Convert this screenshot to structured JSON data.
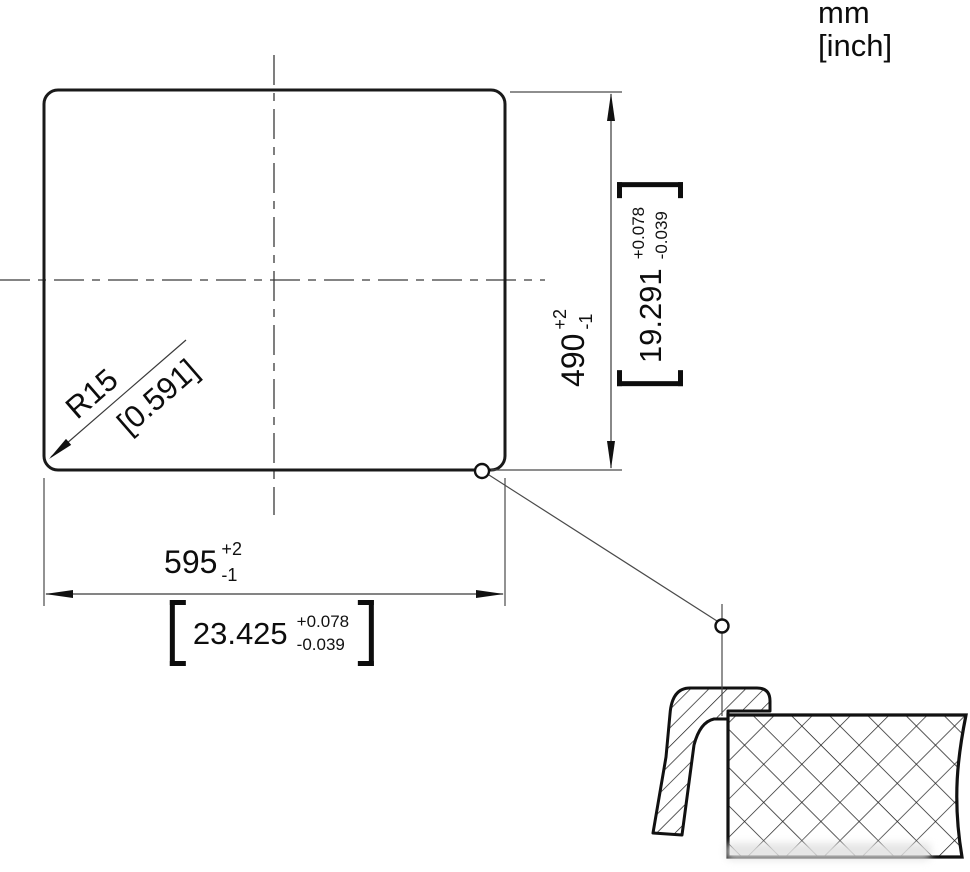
{
  "drawing": {
    "type": "installation cutout dimension drawing",
    "units_legend": {
      "line1": "mm",
      "line2": "[inch]"
    },
    "width_dim": {
      "mm": "595",
      "mm_tol_plus": "+2",
      "mm_tol_minus": "-1",
      "inch": "23.425",
      "inch_tol_plus": "+0.078",
      "inch_tol_minus": "-0.039"
    },
    "height_dim": {
      "mm": "490",
      "mm_tol_plus": "+2",
      "mm_tol_minus": "-1",
      "inch": "19.291",
      "inch_tol_plus": "+0.078",
      "inch_tol_minus": "-0.039"
    },
    "radius_dim": {
      "mm": "R15",
      "inch": "[0.591]"
    },
    "colors": {
      "line": "#1a1a1a",
      "thin_line": "#4a4a4a",
      "background": "#ffffff"
    }
  }
}
